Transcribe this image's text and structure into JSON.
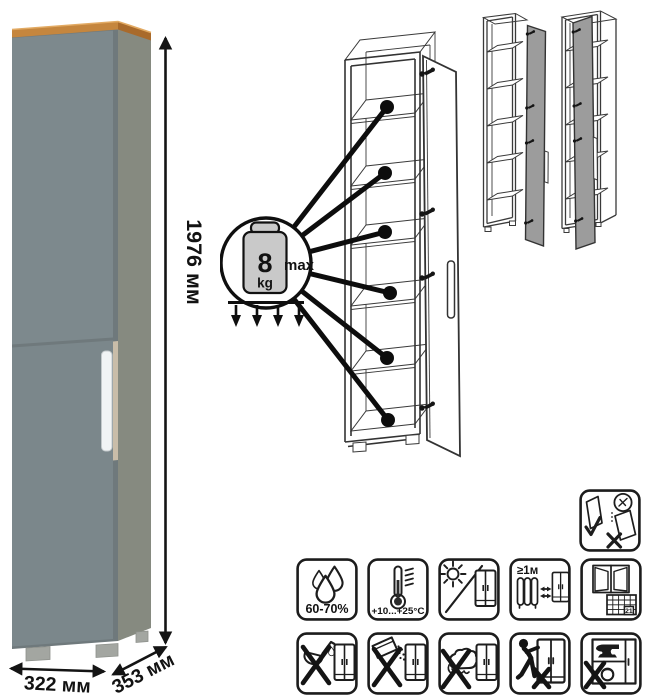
{
  "product": {
    "name": "tall narrow cabinet",
    "dimensions": {
      "height_label": "1976 мм",
      "width_label": "322 мм",
      "depth_label": "353 мм"
    },
    "colors": {
      "door_front": "#7d898d",
      "door_front_lower": "#7b878b",
      "carcase_edge": "#6f797c",
      "carcase_side": "#868a80",
      "top_trim": "#c5863e",
      "top_trim_side": "#a96a2b",
      "handle": "#f1f4f5",
      "handle_recess": "#c9bda9",
      "feet": "#a3a6a1"
    }
  },
  "load_diagram": {
    "value": "8",
    "unit": "kg",
    "qualifier": "max",
    "shelves_indicated": 6
  },
  "variants": {
    "count": 2,
    "door_fill": "#9c9c9c"
  },
  "care": {
    "handling_icon": {
      "name": "door-storage-instruction"
    },
    "row1": [
      {
        "name": "humidity-range-icon",
        "label": "60-70%"
      },
      {
        "name": "temperature-range-icon",
        "label": "+10...+25°C"
      },
      {
        "name": "avoid-direct-sunlight-icon",
        "label": ""
      },
      {
        "name": "min-distance-from-heat-icon",
        "label": "≥1м"
      },
      {
        "name": "ventilation-period-icon",
        "label": "21"
      }
    ],
    "row2": [
      {
        "name": "no-aggressive-liquids-icon"
      },
      {
        "name": "no-abrasive-powders-icon"
      },
      {
        "name": "no-wet-cleaning-icon"
      },
      {
        "name": "no-dragging-icon"
      },
      {
        "name": "no-heavy-overload-icon"
      }
    ]
  }
}
